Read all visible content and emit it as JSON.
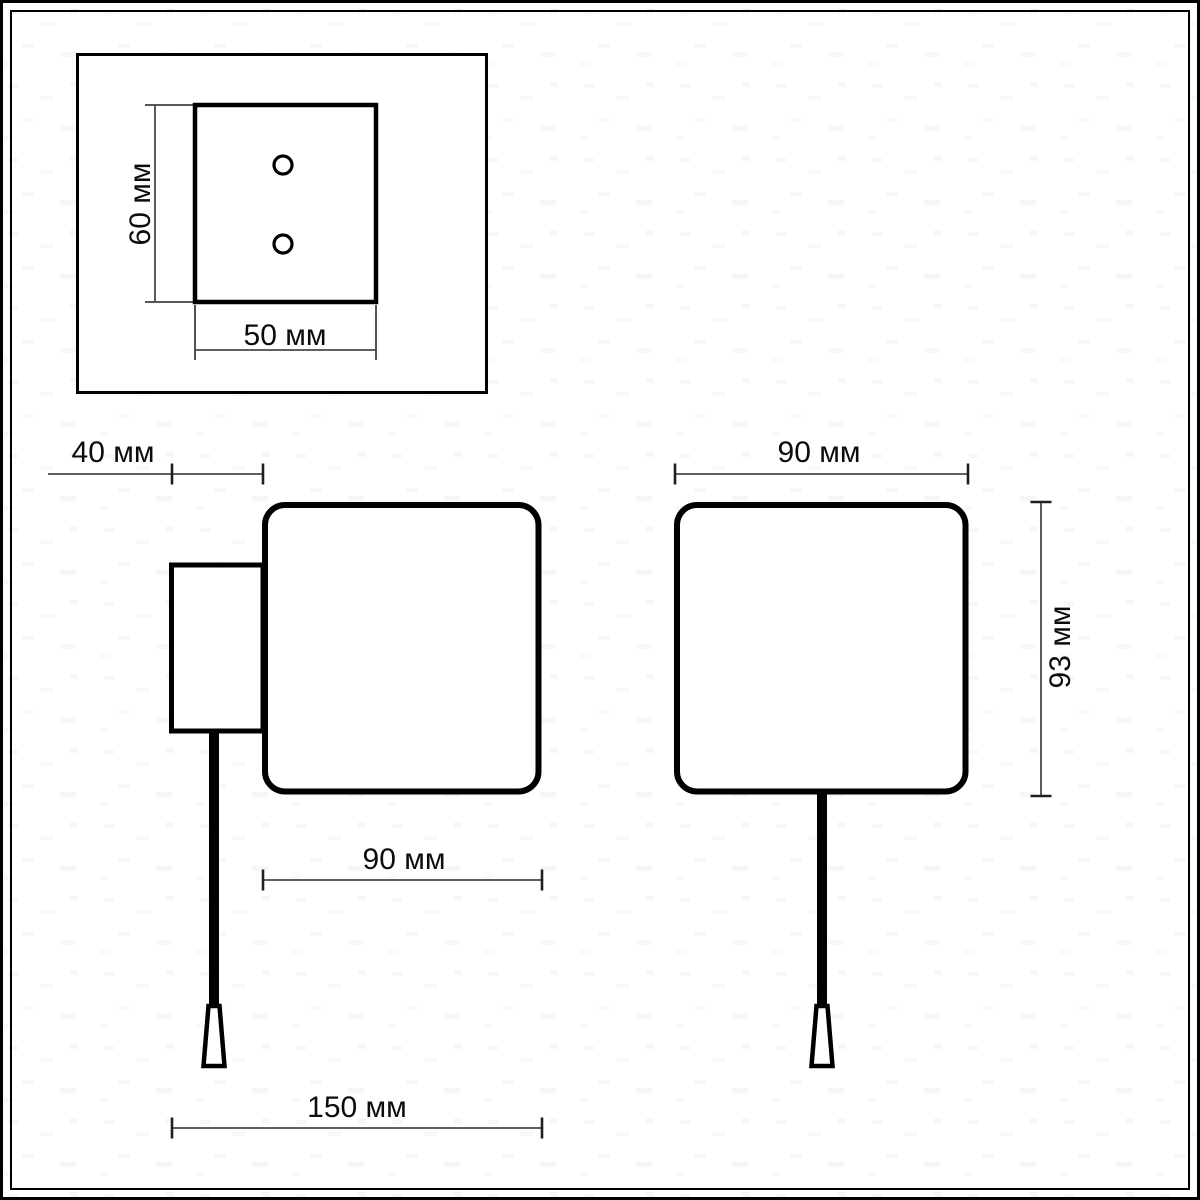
{
  "drawing": {
    "unit": "мм",
    "detail_view": {
      "height_label": "60 мм",
      "width_label": "50 мм"
    },
    "side_view": {
      "bracket_depth_label": "40 мм",
      "body_depth_label": "90 мм",
      "overall_depth_label": "150 мм"
    },
    "front_view": {
      "width_label": "90 мм",
      "height_label": "93 мм"
    }
  },
  "colors": {
    "outline": "#000000",
    "dimension_line": "#4a4a4a",
    "text": "#0c0c0c",
    "background": "#ffffff"
  }
}
